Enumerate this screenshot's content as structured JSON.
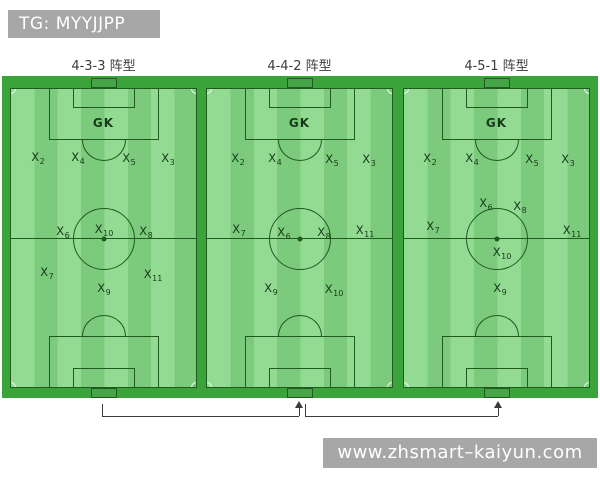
{
  "watermarks": {
    "top": "TG: MYYJJPP",
    "bottom": "www.zhsmart–kaiyun.com"
  },
  "colors": {
    "stripe_light": "#93db93",
    "stripe_dark": "#7ccb7c",
    "frame": "#3aa33a",
    "line": "#1f5a1f",
    "goal_fill": "#46a546",
    "corner": "#eefbee",
    "label": "#17391b",
    "title": "#3c3c3c",
    "watermark_bg": "#a7a7a7",
    "bracket": "#3a3a3a"
  },
  "fields": [
    {
      "title": "4-3-3 阵型",
      "gk": "GK",
      "players": [
        {
          "label": "X",
          "sub": "2",
          "x": 27,
          "y": 70
        },
        {
          "label": "X",
          "sub": "4",
          "x": 67,
          "y": 70
        },
        {
          "label": "X",
          "sub": "5",
          "x": 118,
          "y": 71
        },
        {
          "label": "X",
          "sub": "3",
          "x": 157,
          "y": 71
        },
        {
          "label": "X",
          "sub": "6",
          "x": 52,
          "y": 144
        },
        {
          "label": "X",
          "sub": "10",
          "x": 93,
          "y": 142
        },
        {
          "label": "X",
          "sub": "8",
          "x": 135,
          "y": 144
        },
        {
          "label": "X",
          "sub": "7",
          "x": 36,
          "y": 185
        },
        {
          "label": "X",
          "sub": "11",
          "x": 142,
          "y": 187
        },
        {
          "label": "X",
          "sub": "9",
          "x": 93,
          "y": 201
        }
      ]
    },
    {
      "title": "4-4-2 阵型",
      "gk": "GK",
      "players": [
        {
          "label": "X",
          "sub": "2",
          "x": 31,
          "y": 71
        },
        {
          "label": "X",
          "sub": "4",
          "x": 68,
          "y": 71
        },
        {
          "label": "X",
          "sub": "5",
          "x": 125,
          "y": 72
        },
        {
          "label": "X",
          "sub": "3",
          "x": 162,
          "y": 72
        },
        {
          "label": "X",
          "sub": "7",
          "x": 32,
          "y": 142
        },
        {
          "label": "X",
          "sub": "6",
          "x": 77,
          "y": 145
        },
        {
          "label": "X",
          "sub": "8",
          "x": 117,
          "y": 145
        },
        {
          "label": "X",
          "sub": "11",
          "x": 158,
          "y": 143
        },
        {
          "label": "X",
          "sub": "9",
          "x": 64,
          "y": 201
        },
        {
          "label": "X",
          "sub": "10",
          "x": 127,
          "y": 202
        }
      ]
    },
    {
      "title": "4-5-1 阵型",
      "gk": "GK",
      "players": [
        {
          "label": "X",
          "sub": "2",
          "x": 26,
          "y": 71
        },
        {
          "label": "X",
          "sub": "4",
          "x": 68,
          "y": 71
        },
        {
          "label": "X",
          "sub": "5",
          "x": 128,
          "y": 72
        },
        {
          "label": "X",
          "sub": "3",
          "x": 164,
          "y": 72
        },
        {
          "label": "X",
          "sub": "6",
          "x": 82,
          "y": 116
        },
        {
          "label": "X",
          "sub": "8",
          "x": 116,
          "y": 119
        },
        {
          "label": "X",
          "sub": "7",
          "x": 29,
          "y": 139
        },
        {
          "label": "X",
          "sub": "11",
          "x": 168,
          "y": 143
        },
        {
          "label": "X",
          "sub": "10",
          "x": 98,
          "y": 165
        },
        {
          "label": "X",
          "sub": "9",
          "x": 96,
          "y": 201
        }
      ]
    }
  ]
}
